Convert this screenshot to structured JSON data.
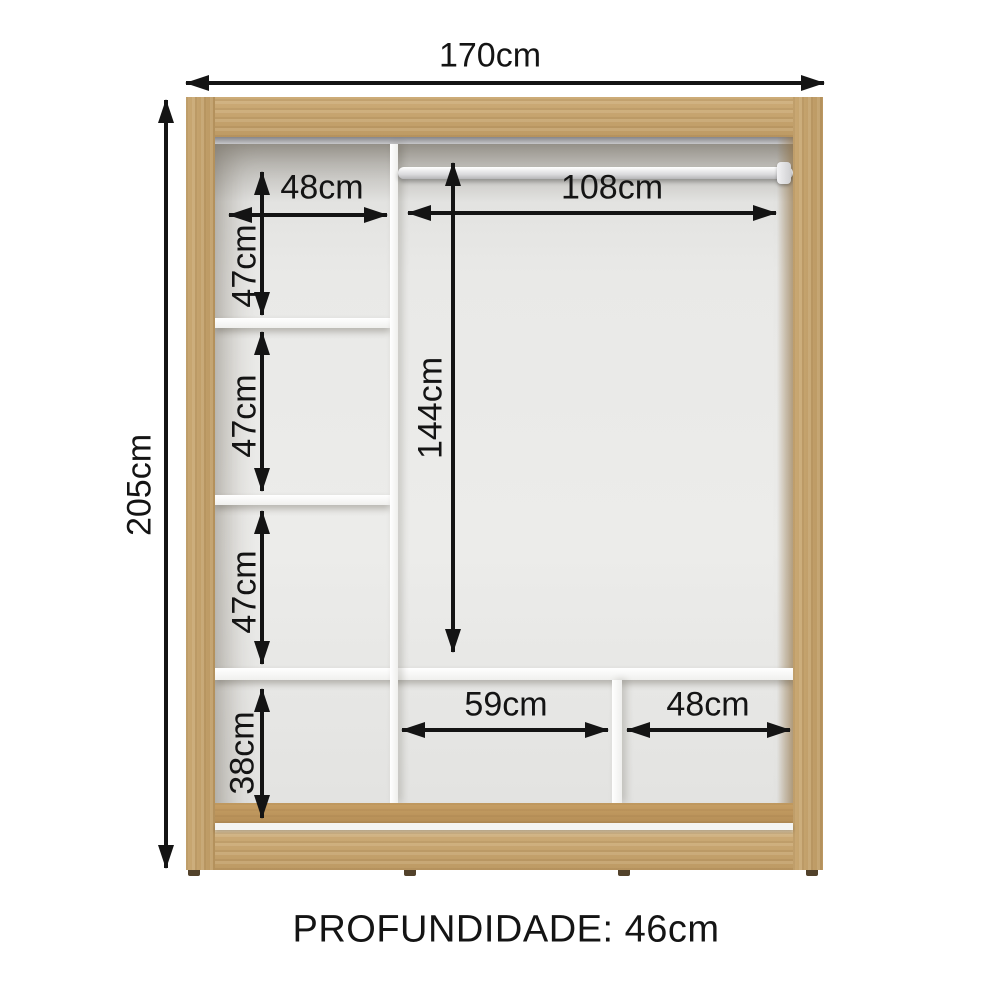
{
  "figure": {
    "kind": "wardrobe-interior-dimension-diagram"
  },
  "measurements": {
    "total_width": "170cm",
    "total_height": "205cm",
    "left_column_width": "48cm",
    "left_section_1_height": "47cm",
    "left_section_2_height": "47cm",
    "left_section_3_height": "47cm",
    "left_bottom_height": "38cm",
    "hanging_width": "108cm",
    "hanging_height": "144cm",
    "bottom_middle_width": "59cm",
    "bottom_right_width": "48cm",
    "depth": "PROFUNDIDADE: 46cm"
  },
  "colors": {
    "wood": "#c2a06b",
    "wood-dark": "#aa8651",
    "wood-floor": "#bd9660",
    "interior": "#e7e7e5",
    "panel": "#f7f7f5",
    "track": "#96969a",
    "arrow": "#141414",
    "background": "#ffffff"
  }
}
